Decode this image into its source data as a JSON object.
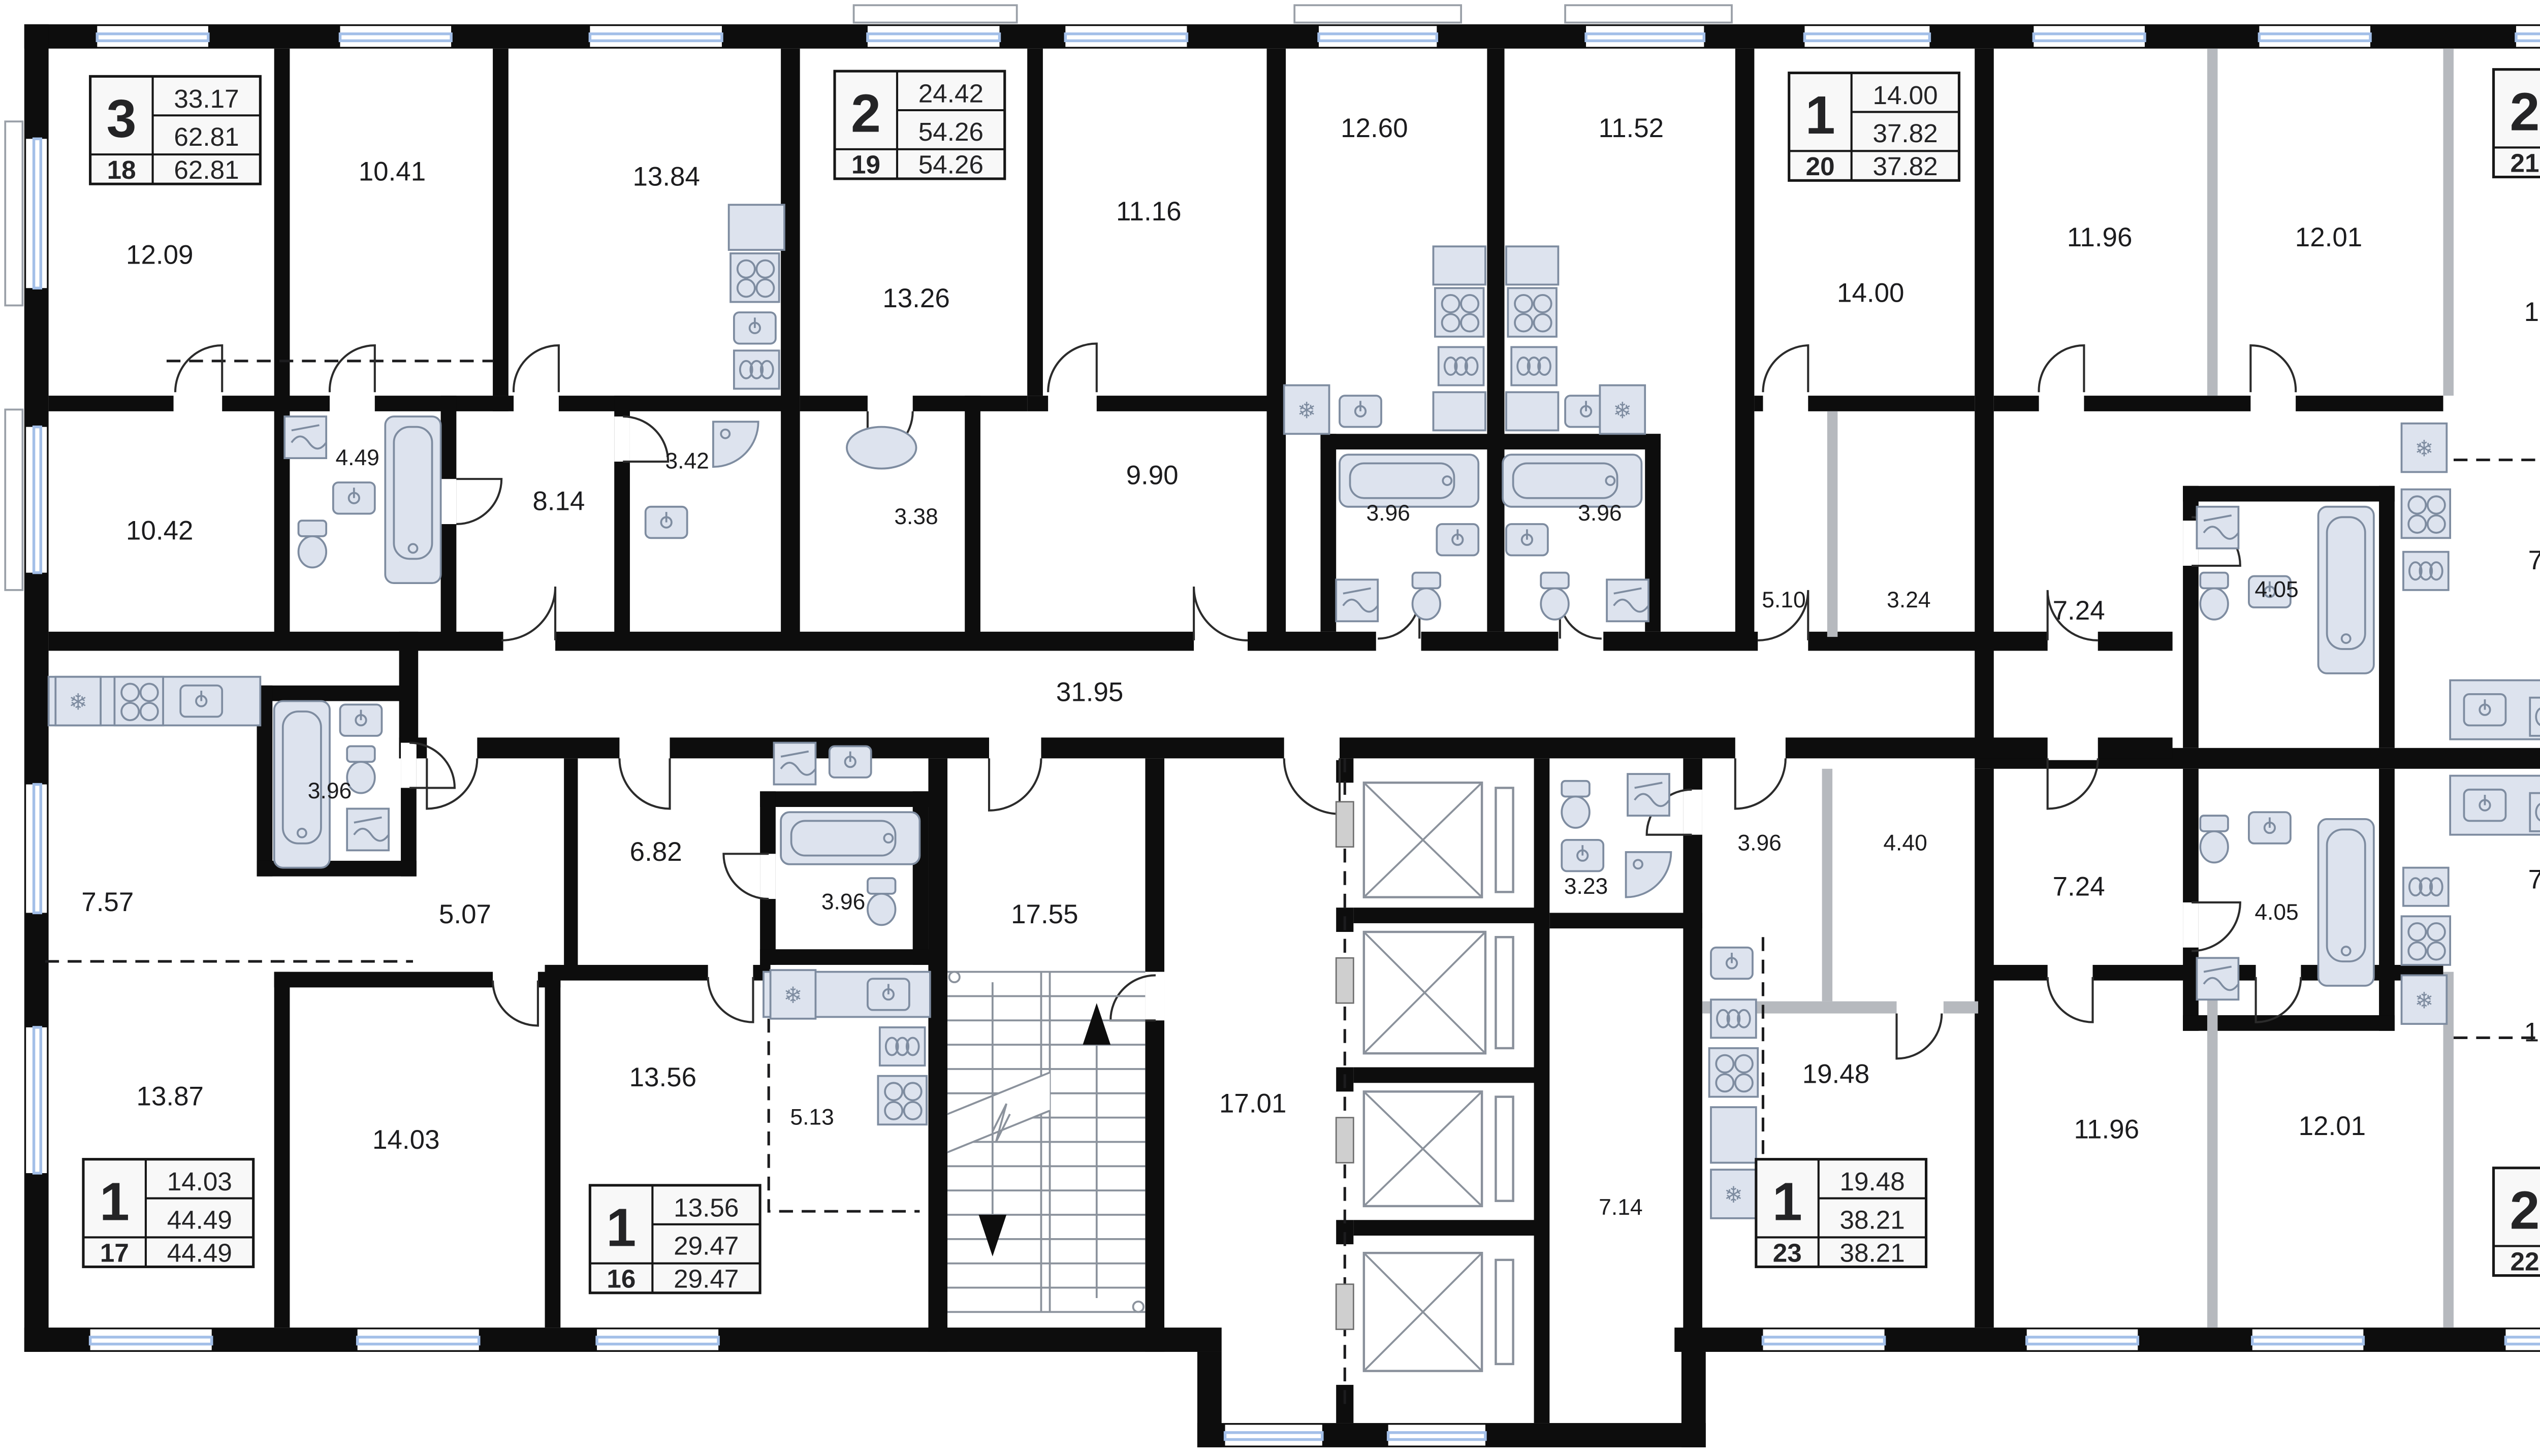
{
  "apartments": [
    {
      "room_count": "3",
      "area_top": "33.17",
      "area_mid": "62.81",
      "number": "18",
      "area_bottom": "62.81"
    },
    {
      "room_count": "2",
      "area_top": "24.42",
      "area_mid": "54.26",
      "number": "19",
      "area_bottom": "54.26"
    },
    {
      "room_count": "1",
      "area_top": "14.00",
      "area_mid": "37.82",
      "number": "20",
      "area_bottom": "37.82"
    },
    {
      "room_count": "2",
      "area_top": "23.97",
      "area_mid": "59.63",
      "number": "21",
      "area_bottom": "59.63"
    },
    {
      "room_count": "1",
      "area_top": "14.03",
      "area_mid": "44.49",
      "number": "17",
      "area_bottom": "44.49"
    },
    {
      "room_count": "1",
      "area_top": "13.56",
      "area_mid": "29.47",
      "number": "16",
      "area_bottom": "29.47"
    },
    {
      "room_count": "1",
      "area_top": "19.48",
      "area_mid": "38.21",
      "number": "23",
      "area_bottom": "38.21"
    },
    {
      "room_count": "2",
      "area_top": "23.97",
      "area_mid": "59.63",
      "number": "22",
      "area_bottom": "59.63"
    }
  ],
  "room_labels": {
    "top": [
      "12.09",
      "10.41",
      "13.84",
      "13.26",
      "11.16",
      "12.60",
      "11.52",
      "14.00",
      "11.96",
      "12.01",
      "16.99"
    ],
    "middle": [
      "10.42",
      "4.49",
      "8.14",
      "3.42",
      "3.38",
      "9.90",
      "3.96",
      "3.96",
      "5.10",
      "3.24",
      "7.24",
      "4.05",
      "7.38"
    ],
    "corridor": "31.95",
    "lower": [
      "3.96",
      "7.57",
      "5.07",
      "6.82",
      "3.96",
      "17.55",
      "3.23",
      "3.96",
      "4.40",
      "7.24",
      "4.05",
      "7.38"
    ],
    "bottom": [
      "13.87",
      "14.03",
      "13.56",
      "5.13",
      "17.01",
      "7.14",
      "19.48",
      "11.96",
      "12.01",
      "16.99"
    ]
  },
  "colors": {
    "wall": "#0d0d0d",
    "partition": "#b6b9be",
    "fixture_fill": "#dde3ee",
    "fixture_stroke": "#7e8ca0",
    "window_glass": "#a3bfe8",
    "text": "#1c1c1e",
    "infobox_fill": "#f8f8f8",
    "background": "#ffffff"
  },
  "icons": {
    "fridge": "snowflake",
    "stove": "four-burners",
    "oven": "coils",
    "bathtub": "tub-outline",
    "sink": "basin",
    "toilet": "bowl",
    "washing_machine": "square-wave",
    "shower": "quarter-circle",
    "elevator": "crossed-box",
    "stairs": "treads-with-arrows"
  }
}
